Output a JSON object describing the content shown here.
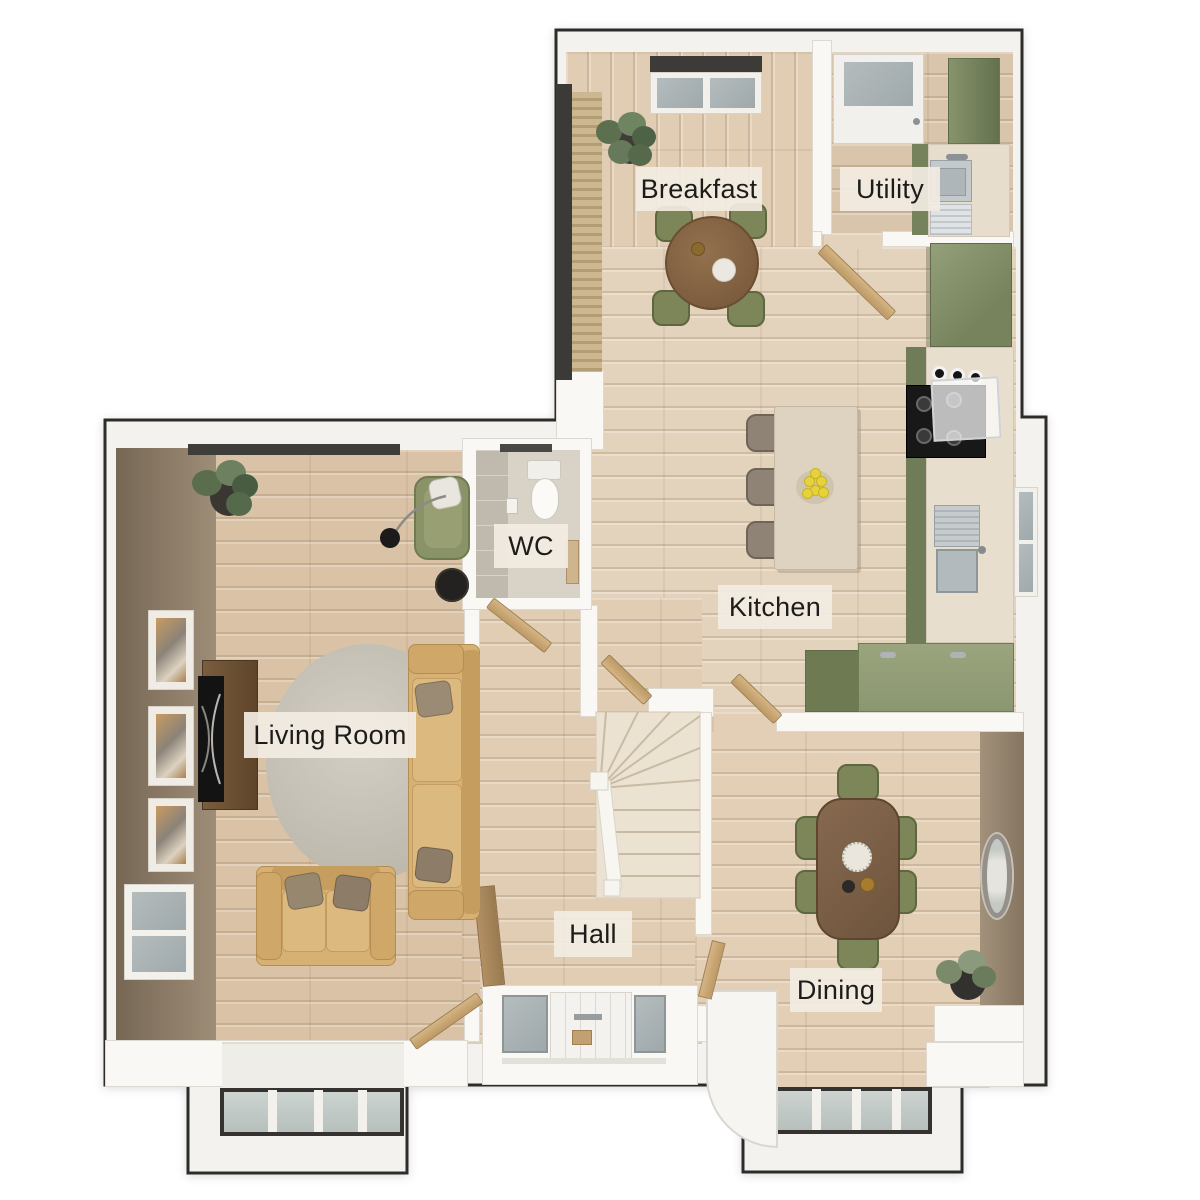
{
  "plan": {
    "type": "floor-plan-3d-top-view",
    "rooms": {
      "breakfast": {
        "label": "Breakfast"
      },
      "utility": {
        "label": "Utility"
      },
      "kitchen": {
        "label": "Kitchen"
      },
      "wc": {
        "label": "WC"
      },
      "living_room": {
        "label": "Living Room"
      },
      "hall": {
        "label": "Hall"
      },
      "dining": {
        "label": "Dining"
      }
    },
    "palette": {
      "outline": "#2d2c2a",
      "wall": "#f4f2ee",
      "wood_floor": "#ddc8af",
      "accent_wall_living": "#8a7a68",
      "accent_wall_dining": "#95836e",
      "cabinet_green": "#7c8960",
      "sofa_tan": "#d6b073",
      "chair_green": "#7d8659",
      "island_cream": "#ddd3c0",
      "rug_grey": "#c6c2b8",
      "window_glass": "#c4ccc9",
      "door_wood": "#c9a877",
      "label_bg": "#f1ebe0",
      "label_text": "#1d1c1a"
    }
  }
}
